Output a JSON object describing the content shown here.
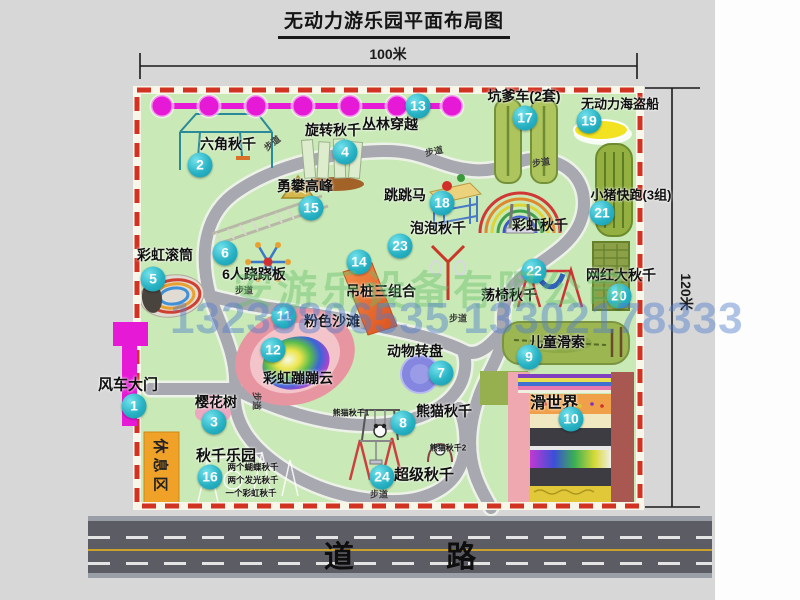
{
  "title": "无动力游乐园平面布局图",
  "dimensions": {
    "width_label": "100米",
    "height_label": "120米"
  },
  "road": {
    "label": "道 路"
  },
  "watermark": {
    "company": "安游乐设备有限公司",
    "phone": "13233806535 13302178333"
  },
  "rest_area": {
    "label": "休息区"
  },
  "items": [
    {
      "num": "1",
      "label": "风车大门",
      "marker": [
        134,
        406
      ],
      "label_pos": [
        128,
        384
      ],
      "size": 15
    },
    {
      "num": "2",
      "label": "六角秋千",
      "marker": [
        200,
        165
      ],
      "label_pos": [
        228,
        144
      ]
    },
    {
      "num": "3",
      "label": "樱花树",
      "marker": [
        214,
        422
      ],
      "label_pos": [
        216,
        402
      ]
    },
    {
      "num": "4",
      "label": "旋转秋千",
      "marker": [
        345,
        152
      ],
      "label_pos": [
        333,
        130
      ]
    },
    {
      "num": "5",
      "label": "彩虹滚筒",
      "marker": [
        153,
        279
      ],
      "label_pos": [
        165,
        255
      ]
    },
    {
      "num": "6",
      "label": "6人跷跷板",
      "marker": [
        225,
        253
      ],
      "label_pos": [
        254,
        274
      ]
    },
    {
      "num": "7",
      "label": "动物转盘",
      "marker": [
        441,
        373
      ],
      "label_pos": [
        415,
        351
      ]
    },
    {
      "num": "8",
      "label": "熊猫秋千",
      "marker": [
        403,
        423
      ],
      "label_pos": [
        444,
        411
      ]
    },
    {
      "num": "9",
      "label": "儿童滑索",
      "marker": [
        529,
        357
      ],
      "label_pos": [
        557,
        342
      ]
    },
    {
      "num": "10",
      "label": "滑世界",
      "marker": [
        571,
        419
      ],
      "label_pos": [
        554,
        401
      ],
      "size": 16
    },
    {
      "num": "11",
      "label": "粉色沙滩",
      "marker": [
        284,
        316
      ],
      "label_pos": [
        332,
        321
      ]
    },
    {
      "num": "12",
      "label": "彩虹蹦蹦云",
      "marker": [
        273,
        350
      ],
      "label_pos": [
        298,
        378
      ]
    },
    {
      "num": "13",
      "label": "丛林穿越",
      "marker": [
        418,
        106
      ],
      "label_pos": [
        390,
        124
      ]
    },
    {
      "num": "14",
      "label": "吊桩三组合",
      "marker": [
        359,
        262
      ],
      "label_pos": [
        381,
        291
      ]
    },
    {
      "num": "15",
      "label": "勇攀高峰",
      "marker": [
        311,
        208
      ],
      "label_pos": [
        305,
        186
      ]
    },
    {
      "num": "16",
      "label": "秋千乐园",
      "marker": [
        210,
        477
      ],
      "label_pos": [
        226,
        455
      ],
      "size": 15
    },
    {
      "num": "17",
      "label": "坑爹车(2套)",
      "marker": [
        525,
        118
      ],
      "label_pos": [
        524,
        96
      ]
    },
    {
      "num": "18",
      "label": "跳跳马",
      "marker": [
        442,
        203
      ],
      "label_pos": [
        405,
        195
      ]
    },
    {
      "num": "19",
      "label": "无动力海盗船",
      "marker": [
        589,
        121
      ],
      "label_pos": [
        620,
        103
      ],
      "size": 13
    },
    {
      "num": "20",
      "label": "网红大秋千",
      "marker": [
        619,
        296
      ],
      "label_pos": [
        621,
        275
      ]
    },
    {
      "num": "21",
      "label": "小猪快跑(3组)",
      "marker": [
        602,
        213
      ],
      "label_pos": [
        631,
        194
      ],
      "size": 13
    },
    {
      "num": "22",
      "label": "荡椅秋千",
      "marker": [
        534,
        271
      ],
      "label_pos": [
        509,
        295
      ]
    },
    {
      "num": "23",
      "label": "泡泡秋千",
      "marker": [
        400,
        246
      ],
      "label_pos": [
        438,
        228
      ]
    },
    {
      "num": "24",
      "label": "超级秋千",
      "marker": [
        382,
        477
      ],
      "label_pos": [
        424,
        474
      ],
      "size": 15
    }
  ],
  "extra_labels": [
    {
      "text": "彩虹秋千",
      "x": 540,
      "y": 225,
      "size": 14
    },
    {
      "text": "熊猫秋千1",
      "x": 351,
      "y": 413,
      "size": 8
    },
    {
      "text": "熊猫秋千2",
      "x": 448,
      "y": 448,
      "size": 8
    },
    {
      "text": "两个蝴蝶秋千",
      "x": 253,
      "y": 467,
      "size": 8.5
    },
    {
      "text": "两个发光秋千",
      "x": 253,
      "y": 480,
      "size": 8.5
    },
    {
      "text": "一个彩虹秋千",
      "x": 251,
      "y": 493,
      "size": 8.5
    }
  ],
  "walkway_labels": [
    {
      "text": "步道",
      "x": 272,
      "y": 143,
      "rot": -38
    },
    {
      "text": "步道",
      "x": 434,
      "y": 151,
      "rot": -12
    },
    {
      "text": "步道",
      "x": 541,
      "y": 162,
      "rot": -8
    },
    {
      "text": "步道",
      "x": 244,
      "y": 290,
      "rot": 0
    },
    {
      "text": "步道",
      "x": 458,
      "y": 318,
      "rot": 0
    },
    {
      "text": "步道",
      "x": 257,
      "y": 401,
      "rot": 90
    },
    {
      "text": "步道",
      "x": 379,
      "y": 494,
      "rot": 0
    }
  ]
}
